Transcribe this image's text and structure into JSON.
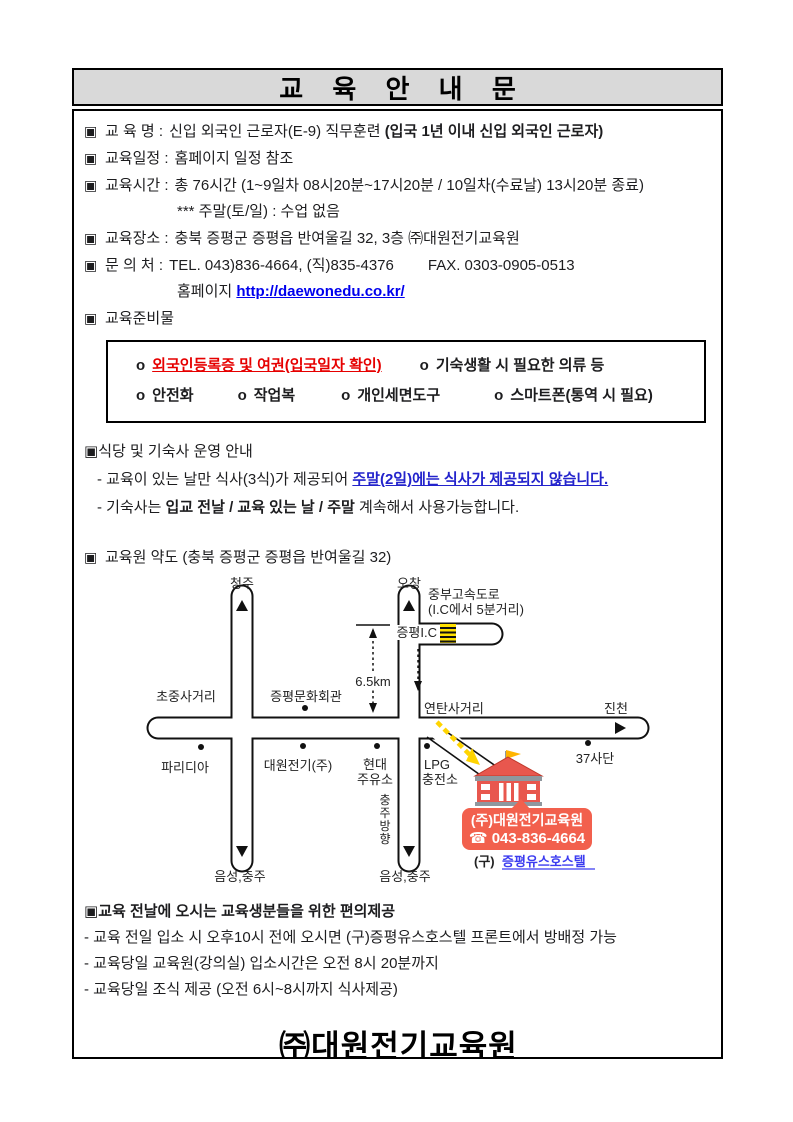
{
  "page": {
    "title": "교 육 안 내 문"
  },
  "lines": {
    "bullet": "▣",
    "course": {
      "label": "교 육 명 :",
      "text": "신입 외국인 근로자(E-9) 직무훈련 ",
      "bold": "(입국 1년 이내 신입 외국인 근로자)"
    },
    "schedule": {
      "label": "교육일정 :",
      "text": "홈페이지 일정 참조"
    },
    "hours": {
      "label": "교육시간 :",
      "text": "총 76시간 (1~9일차 08시20분~17시20분 / 10일차(수료날) 13시20분 종료)"
    },
    "hours_note": "*** 주말(토/일) : 수업 없음",
    "place": {
      "label": "교육장소 :",
      "text": "충북 증평군 증평읍 반여울길 32, 3층 ㈜대원전기교육원"
    },
    "contact": {
      "label": "문 의 처 :",
      "tel": "TEL. 043)836-4664, (직)835-4376",
      "fax": "FAX. 0303-0905-0513"
    },
    "homepage": {
      "label": "홈페이지 ",
      "url": "http://daewonedu.co.kr/"
    },
    "materials_label": "교육준비물"
  },
  "materials_box": {
    "marker": "o",
    "passport": "외국인등록증 및 여권(입국일자 확인)",
    "clothes": "기숙생활 시 필요한 의류 등",
    "safety_shoes": "안전화",
    "work_clothes": "작업복",
    "toiletries": "개인세면도구",
    "smartphone": "스마트폰(통역 시 필요)"
  },
  "dining": {
    "heading": "식당 및 기숙사 운영 안내",
    "meal_pre": "- 교육이 있는 날만 식사(3식)가 제공되어 ",
    "meal_blue": "주말(2일)에는 식사가 제공되지 않습니다.",
    "dorm_pre": "- 기숙사는 ",
    "dorm_bold": "입교 전날 / 교육 있는 날 / 주말",
    "dorm_post": " 계속해서 사용가능합니다."
  },
  "map": {
    "heading": "교육원 약도 (충북 증평군 증평읍 반여울길 32)",
    "labels": {
      "cheongju": "청주",
      "ochang": "오창",
      "highway1": "중부고속도로",
      "highway2": "(I.C에서 5분거리)",
      "ic": "증평I.C",
      "distance": "6.5km",
      "culture_hall": "증평문화회관",
      "chojung_crossing": "초중사거리",
      "yeontan_crossing": "연탄사거리",
      "jincheon": "진천",
      "paridia": "파리디아",
      "daewon_elec": "대원전기(주)",
      "hyundai_line1": "현대",
      "hyundai_line2": "주유소",
      "lpg_line1": "LPG",
      "lpg_line2": "충전소",
      "division37": "37사단",
      "chungju_direction": "충주방향",
      "eumseong_left": "음성,충주",
      "eumseong_right": "음성,충주",
      "center_name": "(주)대원전기교육원",
      "center_tel": "☎ 043-836-4664",
      "former_prefix": "(구)",
      "former_name": "증평유스호스텔"
    }
  },
  "convenience": {
    "heading": "교육 전날에 오시는 교육생분들을 위한 편의제공",
    "line1": "- 교육 전일 입소 시 오후10시 전에 오시면 (구)증평유스호스텔 프론트에서 방배정 가능",
    "line2": "- 교육당일 교육원(강의실) 입소시간은 오전 8시 20분까지",
    "line3": "- 교육당일 조식 제공 (오전 6시~8시까지 식사제공)"
  },
  "footer": {
    "logo": "㈜대원전기교육원"
  },
  "colors": {
    "title_bg": "#d9d9d9",
    "red_text": "#e60000",
    "blue_text": "#2323cc",
    "link_blue": "#0000ee",
    "map_center_box": "#f2604d",
    "ic_marker_yellow": "#ffe100",
    "route_arrow_yellow": "#ffd400",
    "hostel_blue": "#3b3bf0"
  }
}
